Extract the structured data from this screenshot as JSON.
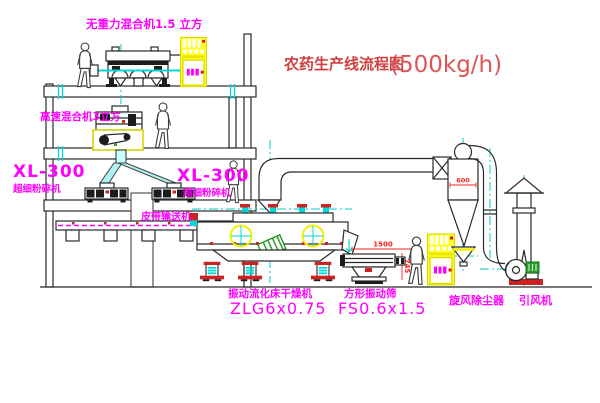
{
  "title": {
    "name": "农药生产线流程图",
    "capacity": "(500kg/h)"
  },
  "labels": {
    "gravity_mixer": "无重力混合机1.5 立方",
    "high_speed_mixer": "高速混合机3立方",
    "crusher_left_model": "XL-300",
    "crusher_left_name": "超细粉碎机",
    "crusher_right_model": "XL-300",
    "crusher_right_name": "超细粉碎机",
    "belt_conveyor": "皮带输送机",
    "dryer_name": "振动流化床干燥机",
    "dryer_model": "ZLG6x0.75",
    "screen_name": "方形振动筛",
    "screen_model": "FS0.6x1.5",
    "cyclone": "旋风除尘器",
    "induced_fan": "引风机"
  },
  "dimensions": {
    "screen_length": "1500",
    "screen_height": "745",
    "cyclone_width": "600"
  },
  "colors": {
    "label_magenta": "#ff00ff",
    "title_red": "#d04040",
    "dimension_red": "#ff2020",
    "line_dark": "#2a2a2a",
    "centerline_cyan": "#00cccc",
    "cabinet_yellow": "#ffff26",
    "motor_green": "#2f9e2f",
    "base_red": "#cc2222"
  }
}
